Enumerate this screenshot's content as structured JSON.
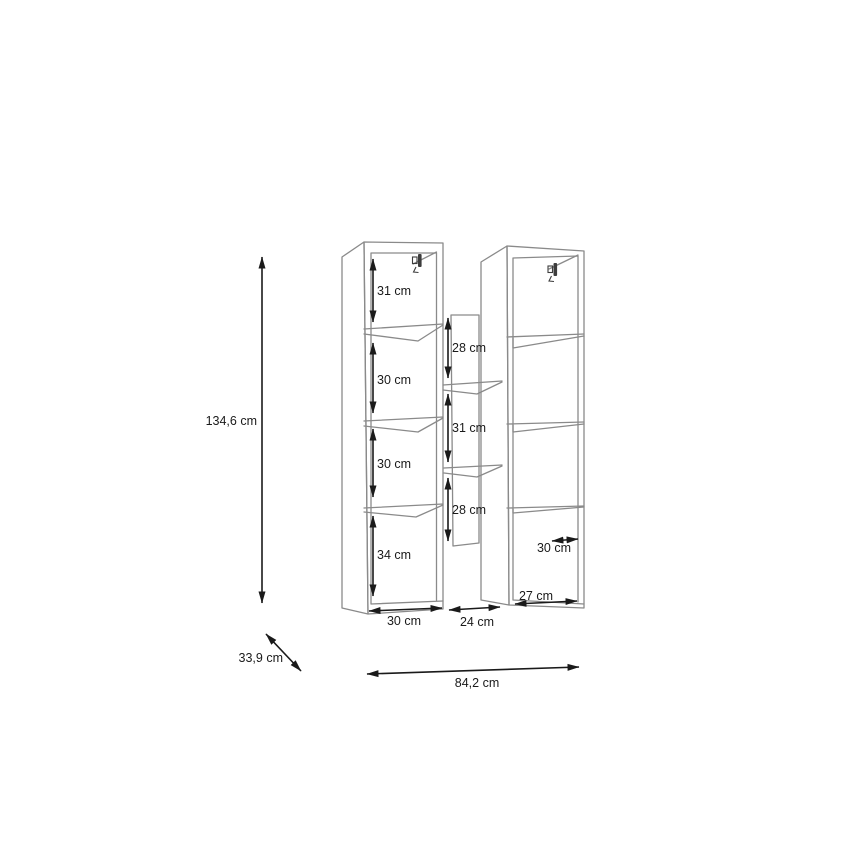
{
  "figure": {
    "kind": "furniture dimension diagram (two wall cabinets with middle open shelf)",
    "overall": {
      "height": "134,6 cm",
      "depth": "33,9 cm",
      "width": "84,2 cm"
    },
    "left_cabinet": {
      "compartments": [
        "31 cm",
        "30 cm",
        "30 cm",
        "34 cm"
      ],
      "width": "30 cm"
    },
    "middle_shelf": {
      "compartments": [
        "28 cm",
        "31 cm",
        "28 cm"
      ],
      "width": "24 cm"
    },
    "right_cabinet": {
      "inner_depth": "30 cm",
      "width": "27 cm"
    }
  },
  "colors": {
    "background": "#ffffff",
    "cabinet_line": "#8a8a8a",
    "dimension_line": "#1a1a1a",
    "text": "#1a1a1a",
    "bracket": "#3d3d3d"
  }
}
